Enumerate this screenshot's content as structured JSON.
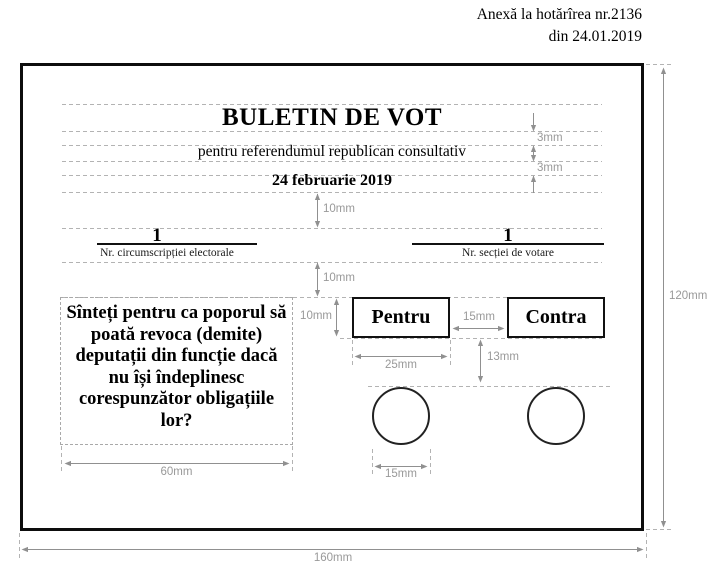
{
  "annex": {
    "line1": "Anexă la hotărîrea nr.2136",
    "line2": "din 24.01.2019"
  },
  "ballot": {
    "title": "BULETIN DE VOT",
    "subtitle": "pentru referendumul republican consultativ",
    "date": "24 februarie 2019",
    "constituency": {
      "number": "1",
      "caption": "Nr. circumscripției electorale"
    },
    "polling_station": {
      "number": "1",
      "caption": "Nr. secției de votare"
    },
    "question": {
      "lines": [
        "Sînteți pentru ca poporul să",
        "poată revoca (demite)",
        "deputații din funcție dacă",
        "nu își îndeplinesc",
        "corespunzător obligațiile",
        "lor?"
      ]
    },
    "options": {
      "for_label": "Pentru",
      "against_label": "Contra"
    }
  },
  "measurements": {
    "gap_title_subtitle": "3mm",
    "gap_subtitle_date": "3mm",
    "gap_date_row": "10mm",
    "gap_row_question": "10mm",
    "option_box_height": "10mm",
    "option_box_gap": "15mm",
    "option_box_width": "25mm",
    "box_to_circle": "13mm",
    "question_box_width": "60mm",
    "circle_diameter": "15mm",
    "ballot_height": "120mm",
    "ballot_width": "160mm"
  },
  "colors": {
    "ink": "#000000",
    "dimension_gray": "#909090",
    "guide_gray": "#b3b3b3",
    "background": "#ffffff"
  }
}
